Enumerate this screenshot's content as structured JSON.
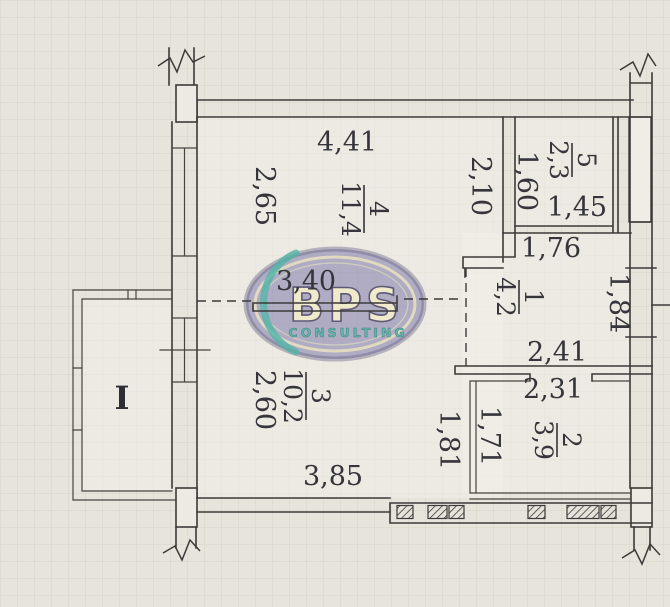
{
  "page": {
    "background": "#e7e4dc",
    "grid_color": "#d9d5c9",
    "line_color": "#3c3b39"
  },
  "watermark": {
    "brand": "BPS",
    "subtitle": "CONSULTING",
    "colors": {
      "oval_fill": "#6864a0",
      "ring": "#eae3bd",
      "brand_fill": "#f1ebc9",
      "subtitle_fill": "#49b1a5",
      "crescent": "#3fae9f"
    }
  },
  "balcony": {
    "label": "I"
  },
  "rooms": {
    "r1": {
      "number": "1",
      "area": "4,2"
    },
    "r2": {
      "number": "2",
      "area": "3,9"
    },
    "r3": {
      "number": "3",
      "area": "10,2"
    },
    "r4": {
      "number": "4",
      "area": "11,4"
    },
    "r5": {
      "number": "5",
      "area": "2,3"
    }
  },
  "dimensions": {
    "d4_width": "4,41",
    "d4_left": "2,65",
    "d4_right": "2,10",
    "d4_inner": "3,40",
    "d5_left": "1,60",
    "d5_width": "1,45",
    "d1_top": "1,76",
    "d1_right": "1,84",
    "d1_bottom": "2,41",
    "d2_top": "2,31",
    "d2_left": "1,71",
    "d3_left": "2,60",
    "d3_bottom": "3,85",
    "d3_right": "1,81"
  }
}
